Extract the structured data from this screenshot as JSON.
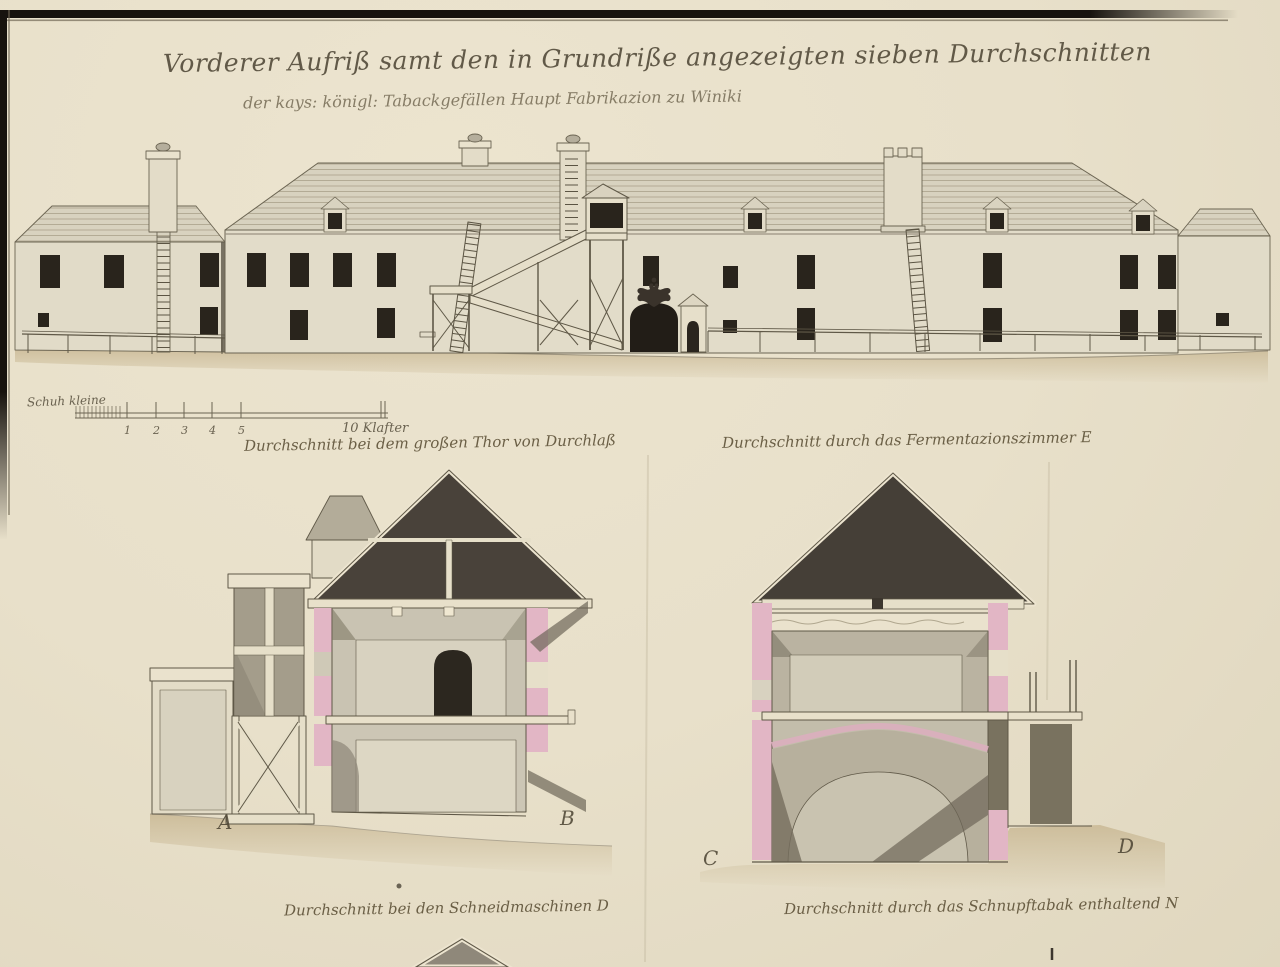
{
  "page": {
    "title": "Vorderer Aufriß samt den in Grundriße angezeigten sieben Durchschnitten",
    "subtitle": "der kays: königl: Tabackgefällen Haupt Fabrikazion zu Winiki"
  },
  "scale_bar": {
    "unit_label": "Schuh kleine",
    "tick_labels": [
      "1",
      "2",
      "3",
      "4",
      "5"
    ],
    "end_label": "10 Klafter"
  },
  "captions": {
    "gate": "Durchschnitt bei dem großen Thor von Durchlaß",
    "fermentation": "Durchschnitt durch das Fermentazionszimmer E",
    "cutting": "Durchschnitt bei den Schneidmaschinen D",
    "snuff": "Durchschnitt durch das Schnupftabak enthaltend N"
  },
  "letters": {
    "a": "A",
    "b": "B",
    "c": "C",
    "d": "D"
  },
  "colors": {
    "paper": "#e8e0ca",
    "ink": "#5b5443",
    "roof_section_dark": "#49423a",
    "cut_wall_pink": "#e2b6c5",
    "window_dark": "#29241c",
    "ground_tan": "#c9b894",
    "frame_black": "#17130e"
  }
}
